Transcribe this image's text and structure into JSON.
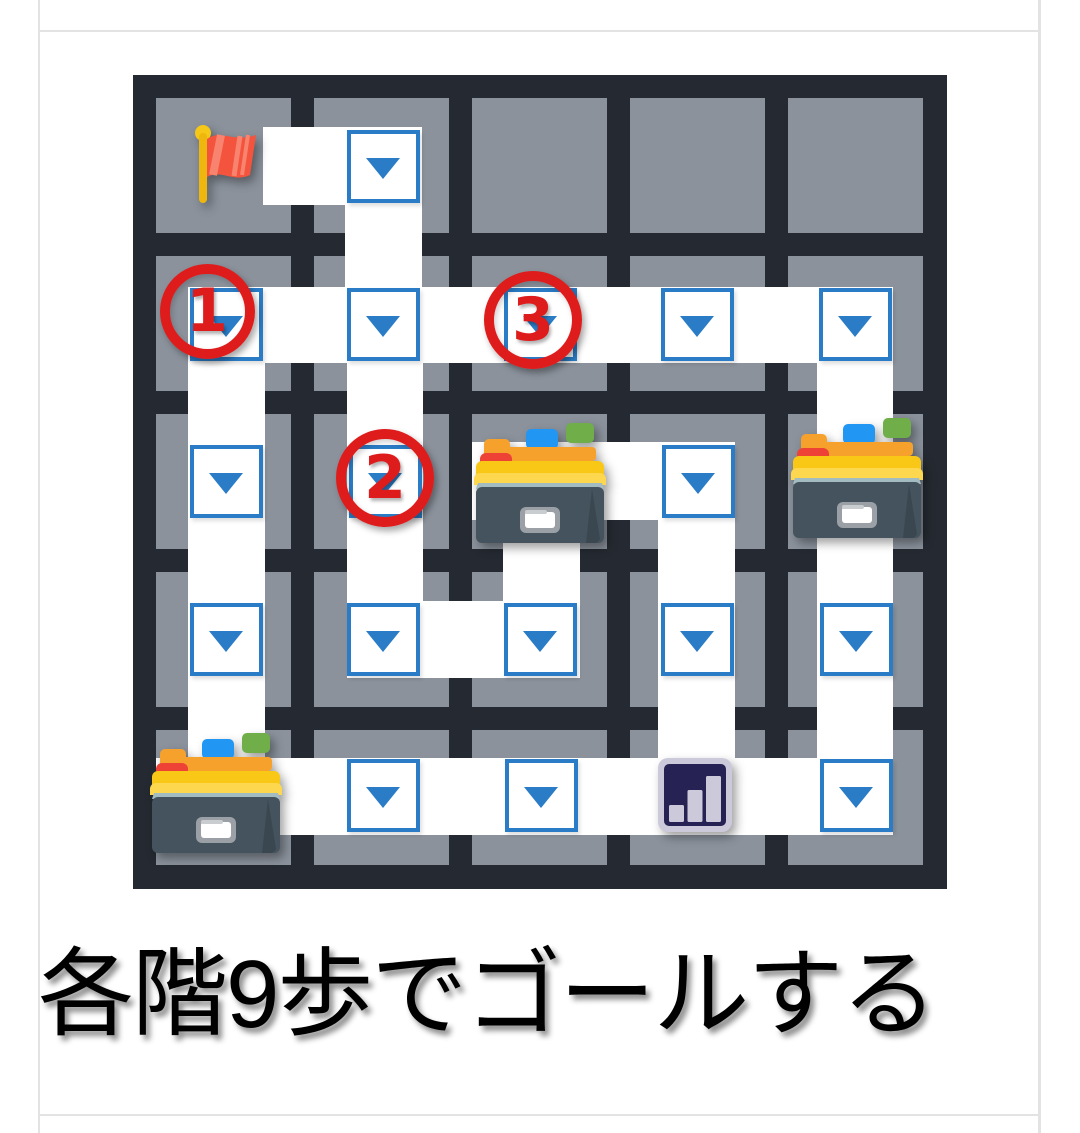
{
  "page": {
    "background": "#ffffff",
    "border_color": "#e3e3e3",
    "borders": {
      "left_x": 38,
      "right_x": 1038,
      "top_y": 30,
      "bottom_y": 1114
    }
  },
  "caption": {
    "text": "各階9歩でゴールする",
    "color": "#000000"
  },
  "board": {
    "x": 133,
    "y": 75,
    "size": 814,
    "background": "#252a32",
    "cell_color": "#8b929c",
    "path_color": "#ffffff",
    "rows": 5,
    "cols": 5,
    "cell_size": 135,
    "cell_offsets": [
      23,
      181,
      339,
      497,
      655
    ]
  },
  "paths": [
    {
      "x": 130,
      "y": 52,
      "w": 159,
      "h": 78
    },
    {
      "x": 212,
      "y": 130,
      "w": 77,
      "h": 82
    },
    {
      "x": 55,
      "y": 212,
      "w": 705,
      "h": 76
    },
    {
      "x": 55,
      "y": 288,
      "w": 77,
      "h": 395
    },
    {
      "x": 214,
      "y": 288,
      "w": 76,
      "h": 315
    },
    {
      "x": 214,
      "y": 526,
      "w": 233,
      "h": 77
    },
    {
      "x": 339,
      "y": 367,
      "w": 263,
      "h": 78
    },
    {
      "x": 370,
      "y": 445,
      "w": 77,
      "h": 81
    },
    {
      "x": 525,
      "y": 370,
      "w": 77,
      "h": 313
    },
    {
      "x": 684,
      "y": 288,
      "w": 76,
      "h": 395
    },
    {
      "x": 23,
      "y": 683,
      "w": 737,
      "h": 77
    }
  ],
  "dropdown": {
    "border_color": "#2a7cc6",
    "arrow_color": "#2a7cc6",
    "size": 73,
    "cells": [
      {
        "row": 1,
        "col": 2,
        "cx": 250,
        "cy": 91
      },
      {
        "row": 2,
        "col": 1,
        "cx": 93,
        "cy": 249
      },
      {
        "row": 2,
        "col": 2,
        "cx": 250,
        "cy": 249
      },
      {
        "row": 2,
        "col": 3,
        "cx": 407,
        "cy": 249
      },
      {
        "row": 2,
        "col": 4,
        "cx": 564,
        "cy": 249
      },
      {
        "row": 2,
        "col": 5,
        "cx": 722,
        "cy": 249
      },
      {
        "row": 3,
        "col": 1,
        "cx": 93,
        "cy": 406
      },
      {
        "row": 3,
        "col": 2,
        "cx": 252,
        "cy": 406
      },
      {
        "row": 3,
        "col": 4,
        "cx": 565,
        "cy": 406
      },
      {
        "row": 4,
        "col": 1,
        "cx": 93,
        "cy": 564
      },
      {
        "row": 4,
        "col": 2,
        "cx": 250,
        "cy": 564
      },
      {
        "row": 4,
        "col": 3,
        "cx": 407,
        "cy": 564
      },
      {
        "row": 4,
        "col": 4,
        "cx": 564,
        "cy": 564
      },
      {
        "row": 4,
        "col": 5,
        "cx": 723,
        "cy": 564
      },
      {
        "row": 5,
        "col": 2,
        "cx": 250,
        "cy": 720
      },
      {
        "row": 5,
        "col": 3,
        "cx": 408,
        "cy": 720
      },
      {
        "row": 5,
        "col": 5,
        "cx": 723,
        "cy": 720
      }
    ]
  },
  "markers": {
    "flag": {
      "icon": "triangular-flag-icon",
      "row": 1,
      "col": 1,
      "cx": 92,
      "cy": 90
    },
    "circle_color": "#df1c1c",
    "circles": [
      {
        "label": "1",
        "cx": 74,
        "cy": 236,
        "diameter": 95
      },
      {
        "label": "2",
        "cx": 252,
        "cy": 403,
        "diameter": 98
      },
      {
        "label": "3",
        "cx": 400,
        "cy": 245,
        "diameter": 98
      }
    ],
    "card_boxes": [
      {
        "icon": "card-file-box-icon",
        "row": 3,
        "col": 3,
        "cx": 407,
        "cy": 406
      },
      {
        "icon": "card-file-box-icon",
        "row": 3,
        "col": 5,
        "cx": 724,
        "cy": 401
      },
      {
        "icon": "card-file-box-icon",
        "row": 5,
        "col": 1,
        "cx": 83,
        "cy": 716
      }
    ],
    "bar_chart": {
      "icon": "bar-chart-icon",
      "row": 5,
      "col": 4,
      "cx": 562,
      "cy": 720,
      "frame_color": "#cbc9da",
      "panel_color": "#262254"
    }
  }
}
